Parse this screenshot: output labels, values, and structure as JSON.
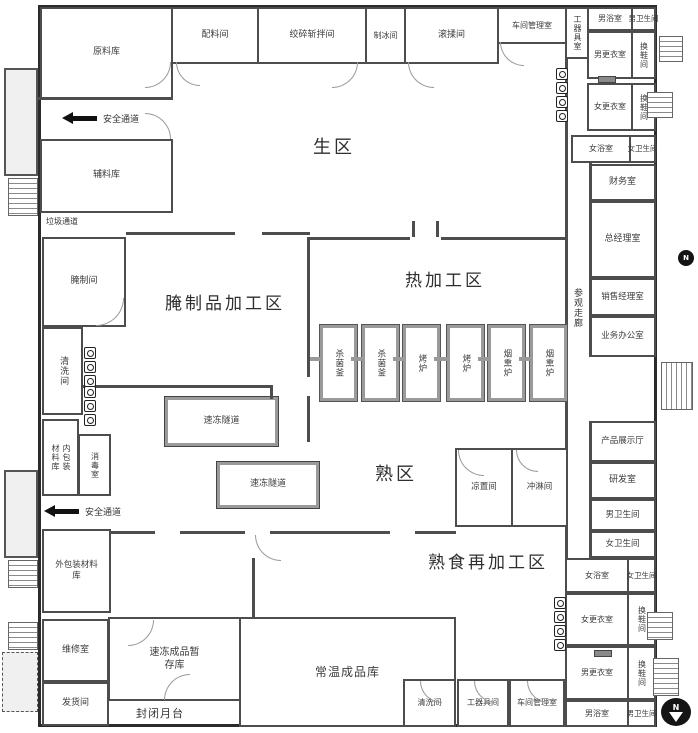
{
  "zones": {
    "raw": "生区",
    "cured": "腌制品加工区",
    "hot": "热加工区",
    "cooked": "熟区",
    "cooked_re": "熟食再加工区"
  },
  "rooms": {
    "raw_material": "原料库",
    "ingredient": "配料间",
    "grinding": "绞碎斩拌间",
    "ice": "制冰间",
    "tumbling": "滚揉间",
    "workshop_mgmt_top": "车间管理室",
    "tool_top": "工器具室",
    "mens_bath_top": "男浴室",
    "mens_toilet_top": "男卫生间",
    "mens_changing_top": "男更衣室",
    "shoe1": "换鞋间",
    "womens_changing_top": "女更衣室",
    "shoe2": "换鞋间",
    "womens_bath_top": "女浴室",
    "womens_toilet_top": "女卫生间",
    "finance": "财务室",
    "gm": "总经理室",
    "sales": "销售经理室",
    "business": "业务办公室",
    "corridor": "参观走廊",
    "product_hall": "产品展示厅",
    "rnd": "研发室",
    "mens_toilet_mid": "男卫生间",
    "womens_toilet_mid": "女卫生间",
    "womens_bath_bot": "女浴室",
    "womens_toilet_bot": "女卫生间",
    "womens_changing_bot": "女更衣室",
    "shoe3": "换鞋间",
    "mens_changing_bot": "男更衣室",
    "shoe4": "换鞋间",
    "mens_bath_bot": "男浴室",
    "mens_toilet_bot": "男卫生间",
    "aux_material": "辅料库",
    "curing": "腌制间",
    "washing_left": "清洗间",
    "inner_pack_a": "内包装",
    "inner_pack_b": "材料库",
    "disinfection": "消毒室",
    "primary_packing": "一次包装间",
    "outer_pack_a": "外包装材料",
    "outer_pack_b": "库",
    "secondary_packing": "二次包装间",
    "maintenance": "维修室",
    "shipping": "发货间",
    "frozen_a": "速冻成品暂",
    "frozen_b": "存库",
    "platform": "封闭月台",
    "ambient": "常温成品库",
    "washing_bot": "清洗间",
    "tool_bot": "工器具间",
    "workshop_mgmt_bot": "车间管理室",
    "cooling": "凉置间",
    "shower": "冲淋间",
    "tunnel1": "速冻隧道",
    "tunnel2": "速冻隧道"
  },
  "equipment": [
    "杀菌釜",
    "杀菌釜",
    "烤炉",
    "烤炉",
    "烟熏炉",
    "烟熏炉"
  ],
  "annotations": {
    "safe_top": "安全通道",
    "safe_bottom": "安全通道",
    "garbage": "垃圾通道",
    "compass": "N"
  },
  "colors": {
    "wall": "#4d4d4d",
    "equip_line": "#9a9a9a",
    "text": "#333333",
    "dock_fill": "#f0f0f0",
    "arrow": "#111111"
  }
}
